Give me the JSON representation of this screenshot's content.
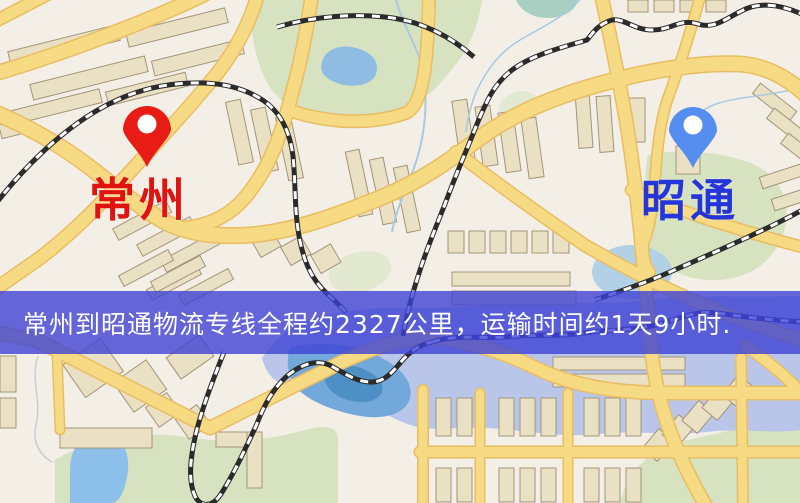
{
  "banner": {
    "text": "常州到昭通物流专线全程约2327公里，运输时间约1天9小时.",
    "background": "rgba(62,66,212,0.8)",
    "text_color": "#ffffff"
  },
  "markers": {
    "origin": {
      "label": "常州",
      "pin_color": "#e91c15",
      "label_color": "#e01310"
    },
    "destination": {
      "label": "昭通",
      "pin_color": "#568df0",
      "label_color": "#2436d9"
    }
  },
  "map_palette": {
    "land": "#f4efe6",
    "park": "#d7e2c1",
    "water": "#8fbce2",
    "road": "#f7da84",
    "road_casing": "#e9bd62",
    "railway": "#2b2b2b",
    "water_railway": "#27307e",
    "building": "#eae0c4"
  }
}
